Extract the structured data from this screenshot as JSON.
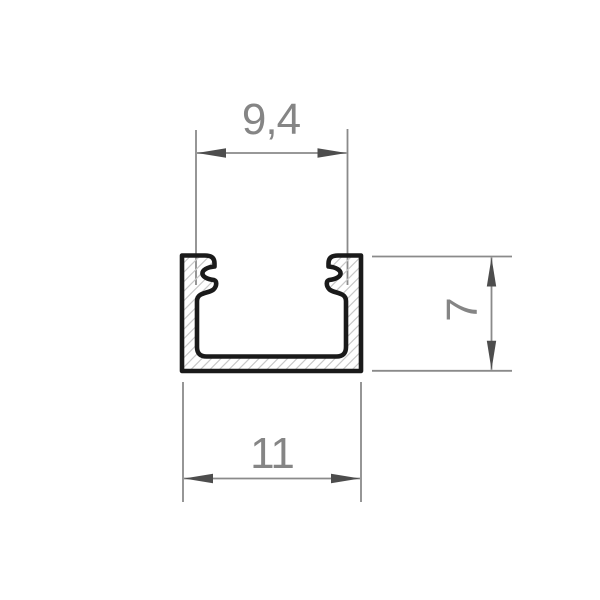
{
  "drawing": {
    "title": "u-channel-profile-cross-section",
    "dimensions": {
      "inner_width": {
        "label": "9,4",
        "value": 9.4,
        "position": "top"
      },
      "outer_width": {
        "label": "11",
        "value": 11,
        "position": "bottom"
      },
      "height": {
        "label": "7",
        "value": 7,
        "position": "right",
        "rotation_deg": -90
      }
    },
    "hatch": {
      "direction": "forward-slash",
      "spacing_px": 9.5
    }
  },
  "colors": {
    "background": "#ffffff",
    "outline": "#1a1a1a",
    "hatch": "#c8c8c8",
    "dim_line": "#8a8a8a",
    "arrow": "#4d4d4d",
    "label": "#858585"
  }
}
